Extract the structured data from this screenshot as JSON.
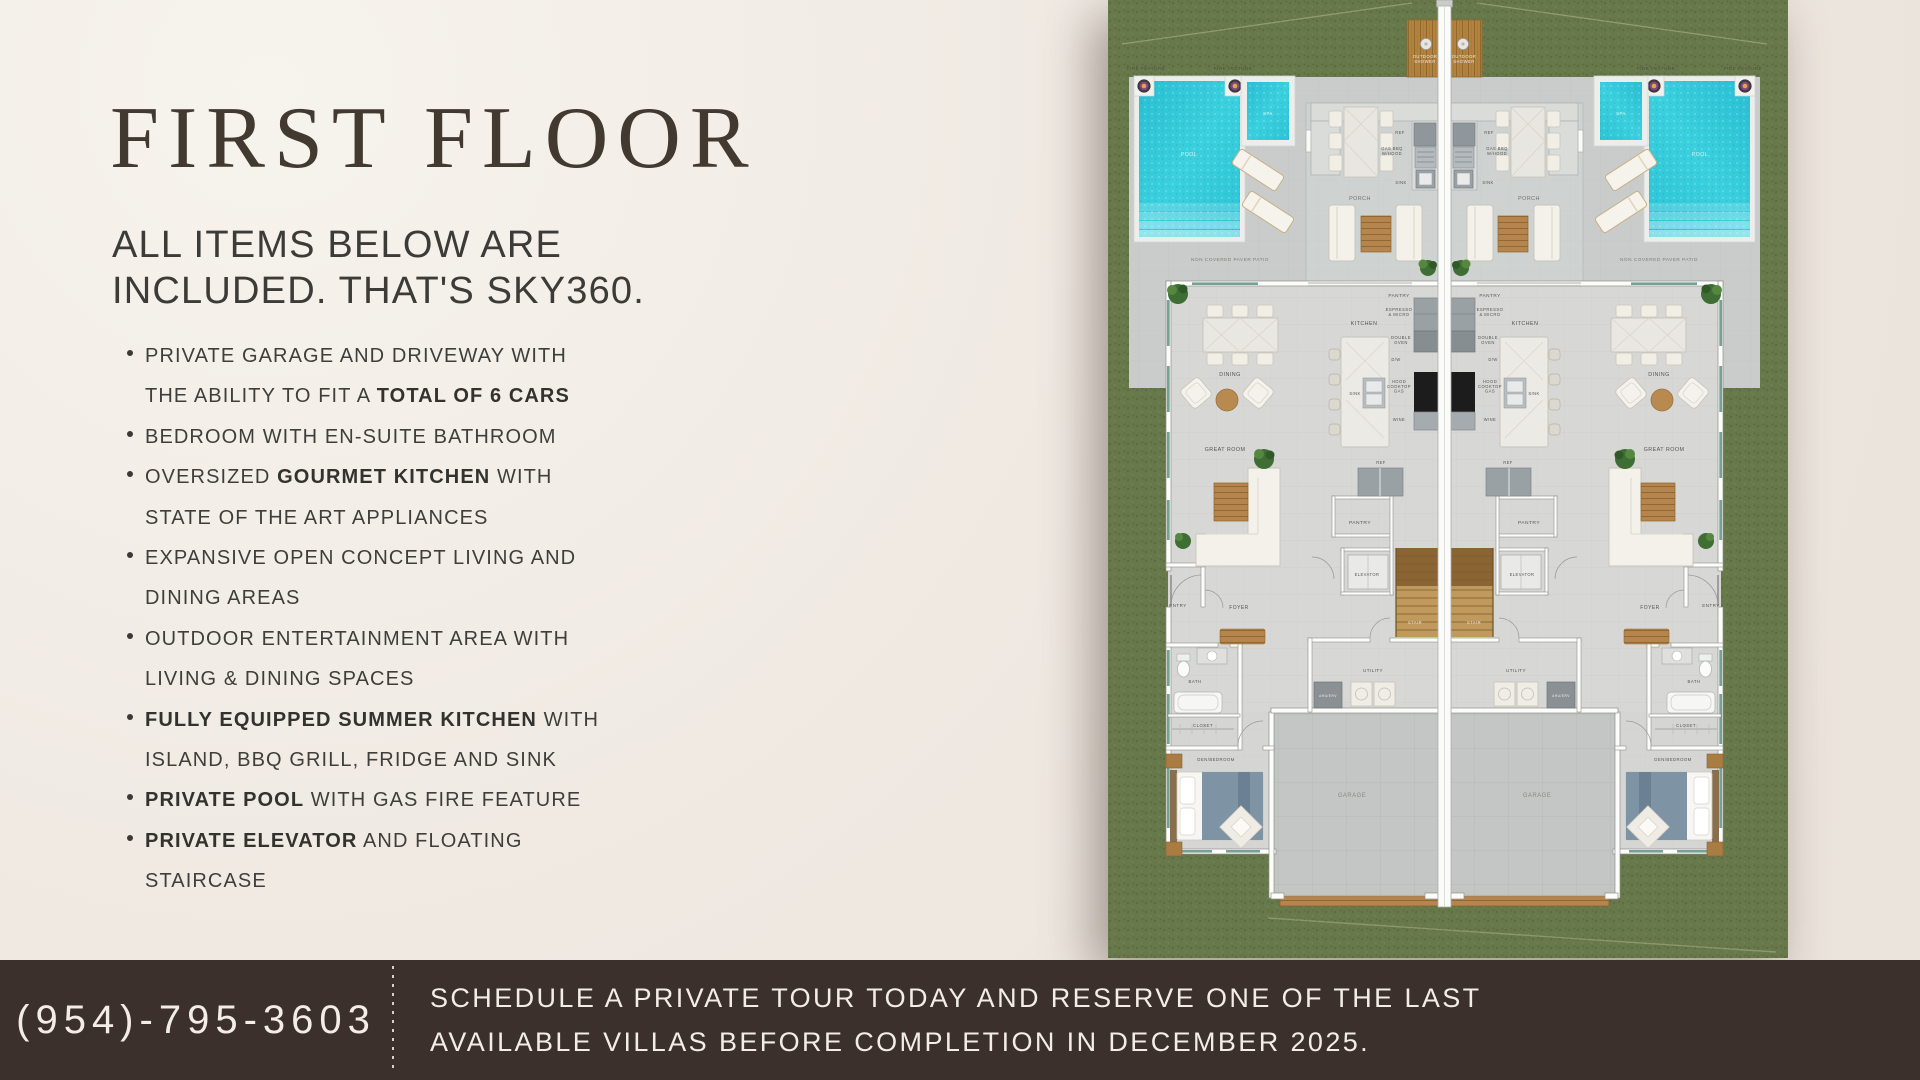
{
  "page": {
    "background": "#efe9e2",
    "accent_dark": "#3b302b"
  },
  "left_panel": {
    "title": "FIRST FLOOR",
    "subtitle_lines": [
      "ALL ITEMS BELOW ARE",
      "INCLUDED. THAT'S SKY360."
    ],
    "bullets": [
      [
        [
          {
            "t": "PRIVATE GARAGE AND DRIVEWAY WITH"
          }
        ],
        [
          {
            "t": "THE ABILITY TO FIT A "
          },
          {
            "t": "TOTAL OF 6 CARS",
            "b": 1
          }
        ]
      ],
      [
        [
          {
            "t": "BEDROOM WITH EN-SUITE BATHROOM"
          }
        ]
      ],
      [
        [
          {
            "t": "OVERSIZED "
          },
          {
            "t": "GOURMET KITCHEN",
            "b": 1
          },
          {
            "t": " WITH"
          }
        ],
        [
          {
            "t": "STATE OF THE ART APPLIANCES"
          }
        ]
      ],
      [
        [
          {
            "t": "EXPANSIVE OPEN CONCEPT LIVING AND"
          }
        ],
        [
          {
            "t": "DINING AREAS"
          }
        ]
      ],
      [
        [
          {
            "t": "OUTDOOR ENTERTAINMENT AREA WITH"
          }
        ],
        [
          {
            "t": "LIVING & DINING SPACES"
          }
        ]
      ],
      [
        [
          {
            "t": "FULLY EQUIPPED SUMMER KITCHEN",
            "b": 1
          },
          {
            "t": " WITH"
          }
        ],
        [
          {
            "t": "ISLAND, BBQ GRILL, FRIDGE AND SINK"
          }
        ]
      ],
      [
        [
          {
            "t": "PRIVATE POOL",
            "b": 1
          },
          {
            "t": " WITH GAS FIRE FEATURE"
          }
        ]
      ],
      [
        [
          {
            "t": "PRIVATE ELEVATOR",
            "b": 1
          },
          {
            "t": " AND FLOATING"
          }
        ],
        [
          {
            "t": "STAIRCASE"
          }
        ]
      ]
    ]
  },
  "footer": {
    "phone": "(954)-795-3603",
    "cta_lines": [
      "SCHEDULE A PRIVATE TOUR TODAY AND RESERVE ONE OF THE LAST",
      "AVAILABLE VILLAS BEFORE COMPLETION IN DECEMBER 2025."
    ]
  },
  "floorplan": {
    "description": "Mirrored duplex villa first-floor plan, two units around central party wall",
    "colors": {
      "grass": "#67784a",
      "patio": "#c9cccb",
      "porch": "#ced2d1",
      "pool": "#2ec7d8",
      "wood": "#b2823f",
      "interior": "#d7d8d6",
      "garage": "#c3c6c4",
      "wall": "#fcfcfa",
      "window": "#74a396"
    },
    "labels": [
      {
        "lines": [
          "FIRE FEATURE"
        ],
        "x": 38,
        "y": 70,
        "size": 4.6,
        "color": "#4a5244"
      },
      {
        "lines": [
          "FIRE FEATURE"
        ],
        "x": 125,
        "y": 70,
        "size": 4.6,
        "color": "#4a5244"
      },
      {
        "lines": [
          "POOL"
        ],
        "x": 81,
        "y": 156,
        "size": 5.2,
        "color": "#d9f5f7"
      },
      {
        "lines": [
          "SPA"
        ],
        "x": 160,
        "y": 115,
        "size": 4.4,
        "color": "#d9f5f7"
      },
      {
        "lines": [
          "OUTDOOR",
          "SHOWER"
        ],
        "x": 317,
        "y": 58,
        "size": 4.2,
        "lh": 5.2,
        "color": "#efe9dd"
      },
      {
        "lines": [
          "NON COVERED PAVER PATIO"
        ],
        "x": 122,
        "y": 261,
        "size": 4.8,
        "color": "#7e7e78"
      },
      {
        "lines": [
          "PORCH"
        ],
        "x": 252,
        "y": 200,
        "size": 5.4,
        "color": "#73736d"
      },
      {
        "lines": [
          "REF"
        ],
        "x": 292,
        "y": 134,
        "size": 4.1
      },
      {
        "lines": [
          "GAS BBQ",
          "W/HOOD"
        ],
        "x": 284,
        "y": 150,
        "size": 4.1,
        "lh": 4.8
      },
      {
        "lines": [
          "SINK"
        ],
        "x": 293,
        "y": 184,
        "size": 4.1
      },
      {
        "lines": [
          "PANTRY"
        ],
        "x": 291,
        "y": 297,
        "size": 4.7
      },
      {
        "lines": [
          "KITCHEN"
        ],
        "x": 256,
        "y": 325,
        "size": 5.4
      },
      {
        "lines": [
          "ESPRESSO",
          "& MICRO"
        ],
        "x": 291,
        "y": 311,
        "size": 4.2,
        "lh": 4.8
      },
      {
        "lines": [
          "DOUBLE",
          "OVEN"
        ],
        "x": 293,
        "y": 339,
        "size": 4.2,
        "lh": 4.8
      },
      {
        "lines": [
          "D/W"
        ],
        "x": 288,
        "y": 361,
        "size": 4.1
      },
      {
        "lines": [
          "SINK"
        ],
        "x": 247,
        "y": 395,
        "size": 4.1
      },
      {
        "lines": [
          "HOOD",
          "COOKTOP",
          "GAS"
        ],
        "x": 291,
        "y": 383,
        "size": 4.2,
        "lh": 4.8
      },
      {
        "lines": [
          "WINE"
        ],
        "x": 291,
        "y": 421,
        "size": 4.1
      },
      {
        "lines": [
          "REF"
        ],
        "x": 273,
        "y": 464,
        "size": 4.1
      },
      {
        "lines": [
          "DINING"
        ],
        "x": 122,
        "y": 376,
        "size": 5.4
      },
      {
        "lines": [
          "GREAT ROOM"
        ],
        "x": 117,
        "y": 451,
        "size": 5.4
      },
      {
        "lines": [
          "PANTRY"
        ],
        "x": 252,
        "y": 524,
        "size": 4.9
      },
      {
        "lines": [
          "ELEVATOR"
        ],
        "x": 259,
        "y": 576,
        "size": 4.1
      },
      {
        "lines": [
          "STAIR"
        ],
        "x": 307,
        "y": 624,
        "size": 4.1,
        "color": "#efe9dc"
      },
      {
        "lines": [
          "ENTRY"
        ],
        "x": 70,
        "y": 607,
        "size": 4.5
      },
      {
        "lines": [
          "FOYER"
        ],
        "x": 131,
        "y": 609,
        "size": 5.0
      },
      {
        "lines": [
          "BATH"
        ],
        "x": 87,
        "y": 683,
        "size": 4.3
      },
      {
        "lines": [
          "CLOSET"
        ],
        "x": 95,
        "y": 727,
        "size": 4.3
      },
      {
        "lines": [
          "DEN/BEDROOM"
        ],
        "x": 108,
        "y": 761,
        "size": 4.3
      },
      {
        "lines": [
          "UTILITY"
        ],
        "x": 265,
        "y": 672,
        "size": 4.5
      },
      {
        "lines": [
          "AHU/ERV"
        ],
        "x": 220,
        "y": 697,
        "size": 3.3,
        "color": "#f0f0ee"
      },
      {
        "lines": [
          "GARAGE"
        ],
        "x": 244,
        "y": 797,
        "size": 6.0,
        "color": "#8b8b86"
      }
    ]
  }
}
